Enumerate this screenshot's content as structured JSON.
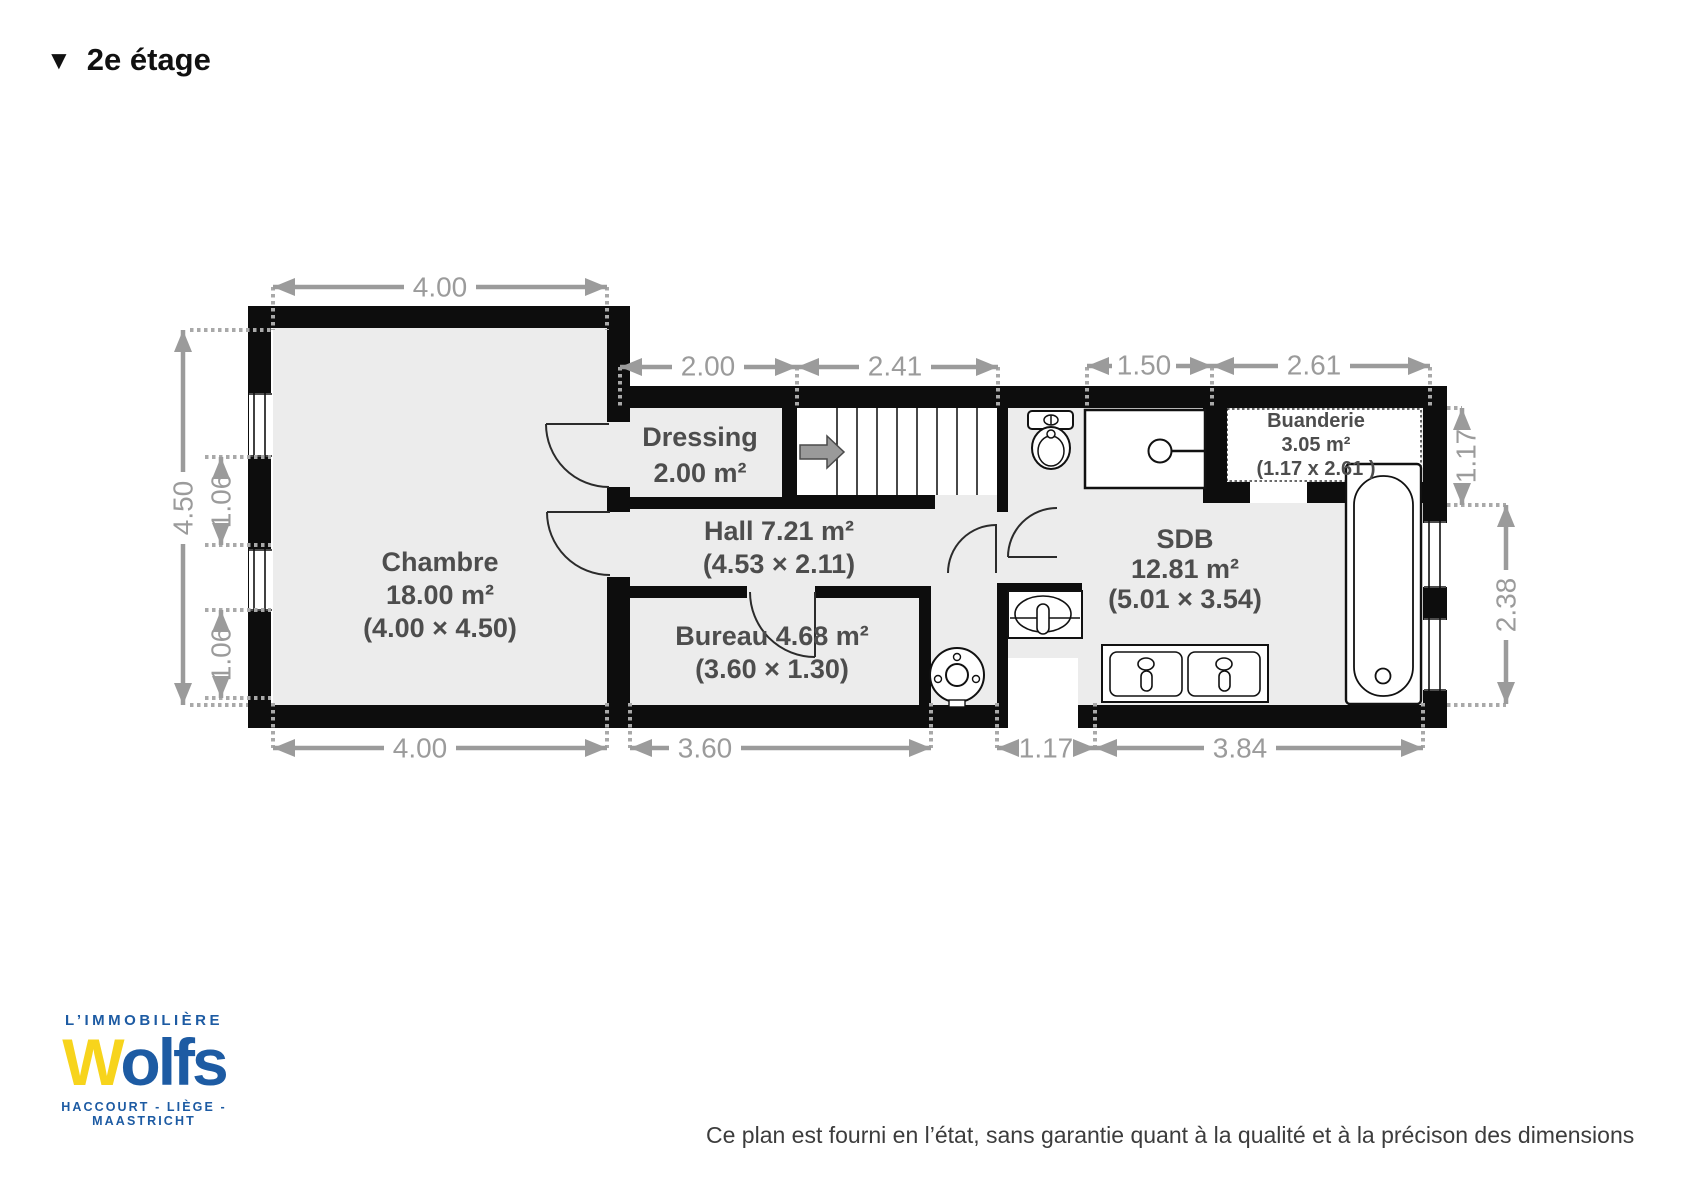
{
  "title": {
    "marker": "▼",
    "text": "2e étage"
  },
  "plan": {
    "rooms": {
      "chambre": {
        "name": "Chambre",
        "area": "18.00 m²",
        "size": "(4.00 × 4.50)"
      },
      "dressing": {
        "name": "Dressing",
        "area": "2.00 m²"
      },
      "hall": {
        "label": "Hall 7.21 m²",
        "size": "(4.53 × 2.11)"
      },
      "bureau": {
        "label": "Bureau 4.68 m²",
        "size": "(3.60 × 1.30)"
      },
      "sdb": {
        "name": "SDB",
        "area": "12.81 m²",
        "size": "(5.01 × 3.54)"
      },
      "buanderie": {
        "name": "Buanderie",
        "area": "3.05 m²",
        "size": "(1.17 x 2.61 )"
      }
    },
    "dimensions": {
      "top": "4.00",
      "upper": [
        "2.00",
        "2.41",
        "1.50",
        "2.61"
      ],
      "bottom": [
        "4.00",
        "3.60",
        "1.17",
        "3.84"
      ],
      "left": [
        "4.50",
        "1.06",
        "1.06"
      ],
      "right": [
        "1.17",
        "2.38"
      ]
    }
  },
  "footer": {
    "logo": {
      "tagline": "L’IMMOBILIÈRE",
      "brand_w": "W",
      "brand_rest": "olfs",
      "cities": "HACCOURT - LIÈGE - MAASTRICHT"
    },
    "disclaimer": "Ce plan est fourni en l’état, sans garantie quant à la qualité et à la précison des dimensions"
  },
  "colors": {
    "wall": "#0d0d0d",
    "room_fill": "#ececec",
    "dimension": "#9b9b9b",
    "room_label": "#4d4d4d",
    "logo_blue": "#1d5ba3",
    "logo_yellow": "#f7d41c"
  }
}
